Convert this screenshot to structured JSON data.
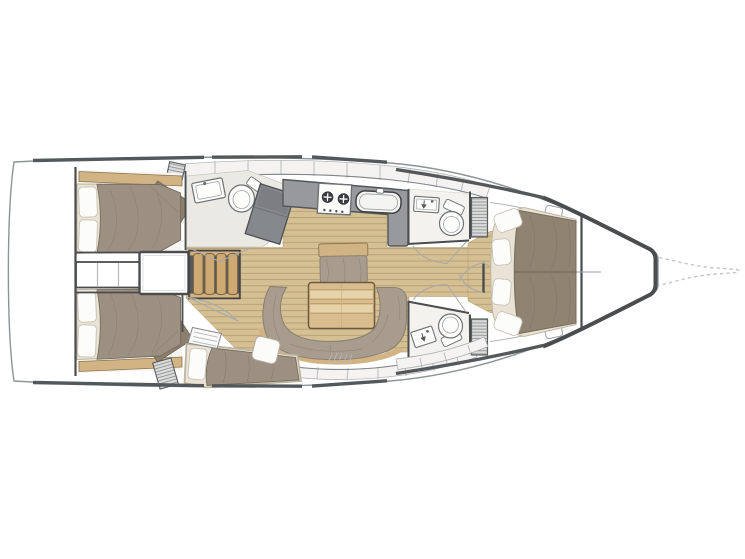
{
  "meta": {
    "title": "Sailing yacht interior layout plan",
    "view": "top-down deck / accommodation plan",
    "orientation": "bow to the right, stern (swim platform) to the left"
  },
  "colors": {
    "background": "#ffffff",
    "hullOutline": "#8e9396",
    "wall": "#4a4c4e",
    "toeRail": "#55585a",
    "cabinetFace": "#f4f3f1",
    "panelLine": "#b9bcbe",
    "counter": "#97999c",
    "lockerGray": "#85888c",
    "woodFloor": "#d5c094",
    "woodPlankLine": "#b79c71",
    "woodTrim": "#d2b384",
    "woodTrimEdge": "#8a744f",
    "stairTread": "#cfa972",
    "tableWood": "#d9bd8e",
    "tableEdge": "#6b5a3c",
    "mattress": "#eae3d5",
    "mattressEdge": "#bdb4a2",
    "pillow": "#fcfcfb",
    "pillowEdge": "#c8c3b6",
    "aftDuvet": "#9c9083",
    "fwdDuvet": "#8f8372",
    "duvetEdge": "#776d5c",
    "sofa": "#a89c8e",
    "sofaEdge": "#8d8172",
    "bathFloor": "#ebe9e4",
    "headFloor": "#f3f2ef",
    "fixtureStroke": "#6e7174",
    "louverLine": "#8f9296",
    "louverBg": "#dcdcda",
    "doorArc": "#a6a9ab",
    "bowsprit": "#c3c6c8"
  },
  "areas": [
    {
      "id": "swim-platform",
      "name": "Transom / swim platform"
    },
    {
      "id": "aft-cabin-top",
      "name": "Aft double cabin (upper)",
      "features": [
        "double berth",
        "2 pillows",
        "side shelf"
      ]
    },
    {
      "id": "aft-cabin-bottom",
      "name": "Aft double cabin (lower)",
      "features": [
        "double berth",
        "2 pillows",
        "side shelf"
      ]
    },
    {
      "id": "engine-compartment",
      "name": "Engine box under companionway"
    },
    {
      "id": "companionway-stairs",
      "name": "Companionway stairs",
      "treads": 4
    },
    {
      "id": "aft-head",
      "name": "Aft head",
      "features": [
        "washbasin",
        "toilet",
        "wet locker"
      ]
    },
    {
      "id": "galley",
      "name": "Linear galley",
      "features": [
        "2-burner stove",
        "sink",
        "refrigerator",
        "lockers"
      ]
    },
    {
      "id": "saloon",
      "name": "Saloon",
      "features": [
        "C-shaped settee",
        "dining table",
        "forward bench seat",
        "side seat"
      ]
    },
    {
      "id": "nav-berth",
      "name": "Chart seat / single berth"
    },
    {
      "id": "fwd-head-top",
      "name": "Forward head (upper)",
      "features": [
        "washbasin",
        "toilet",
        "louvered locker"
      ]
    },
    {
      "id": "fwd-head-bottom",
      "name": "Forward head (lower)",
      "features": [
        "washbasin",
        "toilet",
        "louvered locker"
      ]
    },
    {
      "id": "fwd-cabin",
      "name": "Forward owner cabin",
      "features": [
        "island double berth",
        "4 pillows",
        "deck hatches"
      ]
    },
    {
      "id": "bow-locker",
      "name": "Anchor / sail locker"
    },
    {
      "id": "bowsprit",
      "name": "Bowsprit (dashed outline)"
    }
  ]
}
